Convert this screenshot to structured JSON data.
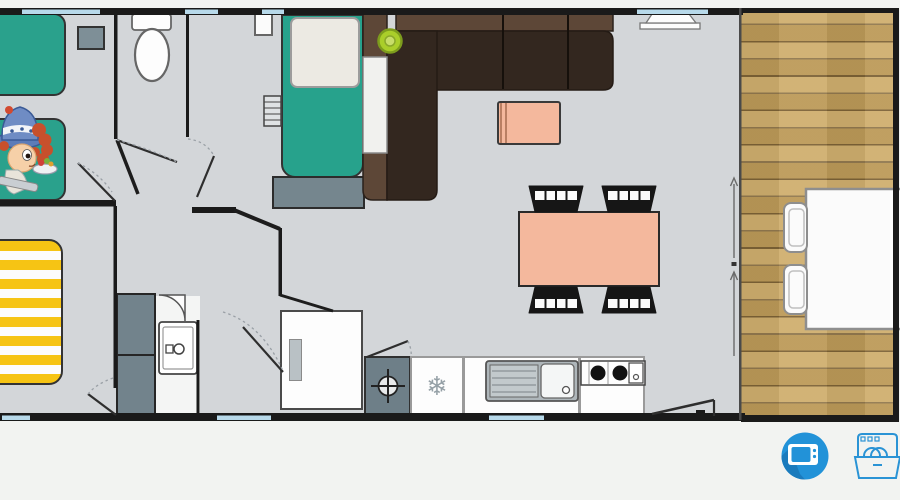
{
  "page": {
    "background": "#f2f3f1",
    "type": "mobile-home-floor-plan"
  },
  "plan": {
    "floor_color": "#d3d6d9",
    "wall_color": "#1a1a1a",
    "window_color": "#b7d9ea",
    "rooms": [
      {
        "name": "children-bedroom-twin-beds"
      },
      {
        "name": "wc"
      },
      {
        "name": "master-bedroom"
      },
      {
        "name": "hallway"
      },
      {
        "name": "shower-room"
      },
      {
        "name": "double-bedroom-yellow"
      },
      {
        "name": "living-room-kitchen"
      },
      {
        "name": "terrace-deck"
      }
    ],
    "furniture_colors": {
      "twin_bed": "#2aa18c",
      "double_bed": "#27a28c",
      "yellow_bed_stripe": "#f6c414",
      "sofa_dark": "#33271f",
      "sofa_light": "#5d4737",
      "table_salmon": "#f4b89d",
      "deck_wood": "#c8a156",
      "pouf": "#aace2a",
      "gray_units": "#72838c"
    }
  },
  "amenities": {
    "tv": {
      "name": "tv",
      "icon": "tv-icon",
      "color": "#2292d8"
    },
    "dishwasher": {
      "name": "dishwasher",
      "icon": "dishwasher-icon",
      "color": "#2a93d5"
    }
  },
  "mascot": {
    "name": "cartoon-child-mascot"
  }
}
